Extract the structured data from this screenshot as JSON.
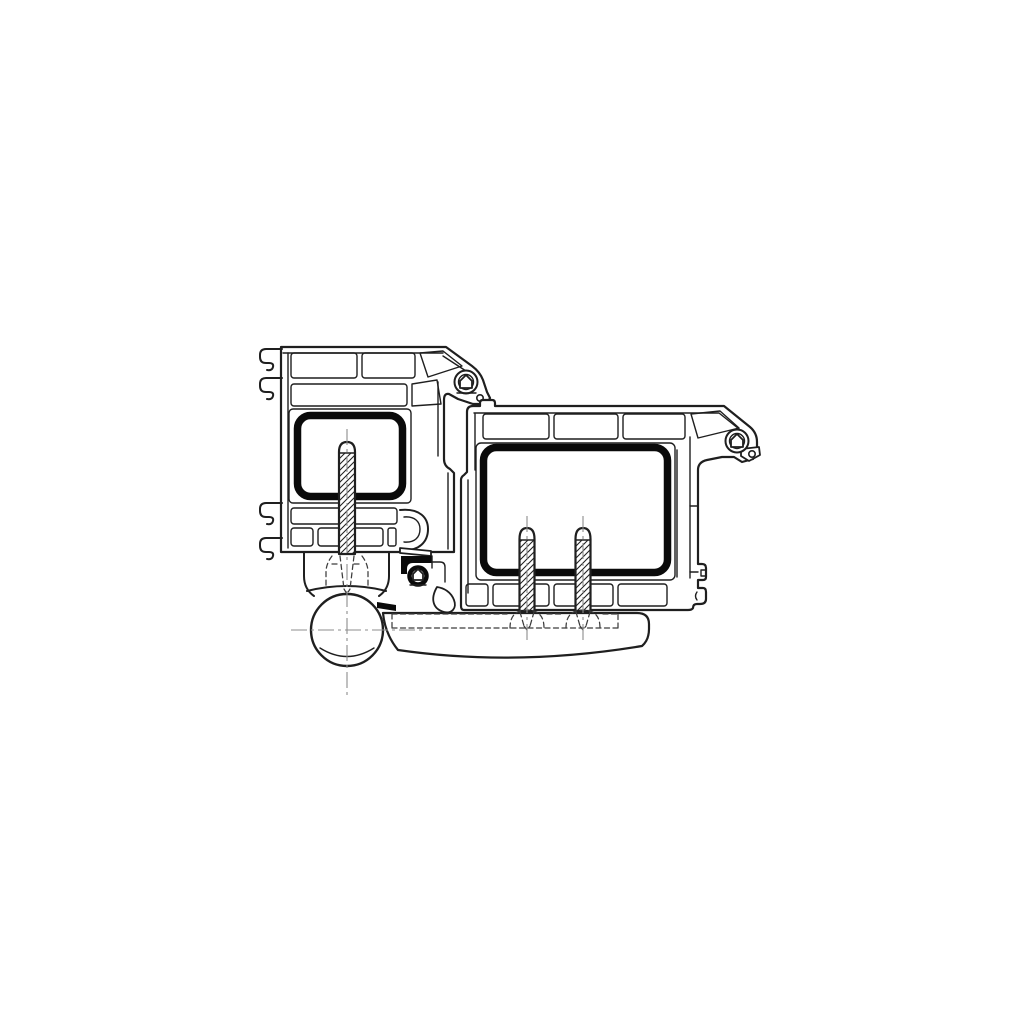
{
  "title": "Door hinge on PVC profiles - cross-section technical drawing",
  "colors": {
    "background": "#ffffff",
    "line": "#1f1f1f",
    "steel": "#0a0a0a",
    "hidden": "#3c3c3c",
    "centerline": "#8c8c8c"
  },
  "parts": {
    "frame_profile": "Frame PVC multi-chamber profile (left)",
    "frame_reinforcement": "Frame steel reinforcement tube",
    "frame_screw": "Frame fixing screw into hinge body",
    "sash_profile": "Sash PVC multi-chamber profile (right)",
    "sash_reinforcement": "Sash steel reinforcement tube",
    "sash_screw_left": "Sash fixing screw (left)",
    "sash_screw_right": "Sash fixing screw (right)",
    "hinge_knuckle": "Hinge knuckle barrel with centerlines",
    "hinge_arm": "Hinge arm plate under sash",
    "frame_gasket": "Frame corner bulb gasket",
    "sash_gasket": "Sash corner bulb gasket",
    "center_seal": "Center seal between frame and sash",
    "hidden_lines": "Hidden hinge geometry (dashed)",
    "centerlines": "Screw and knuckle centerlines"
  },
  "geometry": {
    "canvas": {
      "width": 1024,
      "height": 1024
    },
    "knuckle": {
      "cx": 347,
      "cy": 630,
      "r": 36
    },
    "screw_centers_x": [
      347,
      527,
      583
    ],
    "frame_reinforcement_box": [
      297,
      415,
      403,
      497
    ],
    "sash_reinforcement_box": [
      483,
      447,
      668,
      573
    ]
  }
}
